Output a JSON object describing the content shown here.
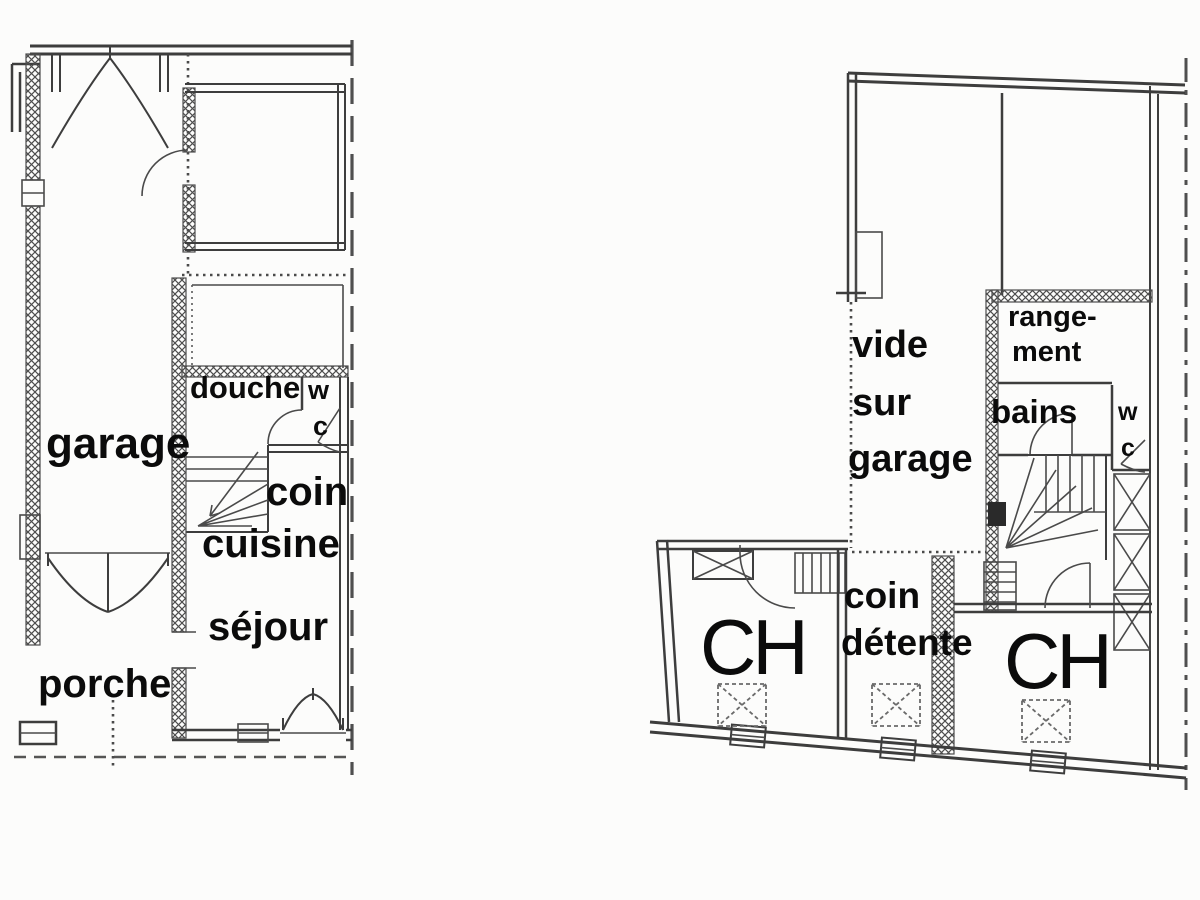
{
  "canvas": {
    "background": "#fcfcfb",
    "ink_color": "#3d3d3d",
    "label_color": "#0b0b0b"
  },
  "ground_floor": {
    "labels": {
      "garage": "garage",
      "douche": "douche",
      "wc_w": "w",
      "wc_c": "c",
      "coin": "coin",
      "cuisine": "cuisine",
      "sejour": "séjour",
      "porche": "porche"
    }
  },
  "upper_floor": {
    "labels": {
      "vide": "vide",
      "sur": "sur",
      "garage": "garage",
      "rangement_line1": "range-",
      "rangement_line2": "ment",
      "bains": "bains",
      "wc_w": "w",
      "wc_c": "c",
      "coin": "coin",
      "detente": "détente",
      "ch_left": "CH",
      "ch_right": "CH"
    }
  }
}
